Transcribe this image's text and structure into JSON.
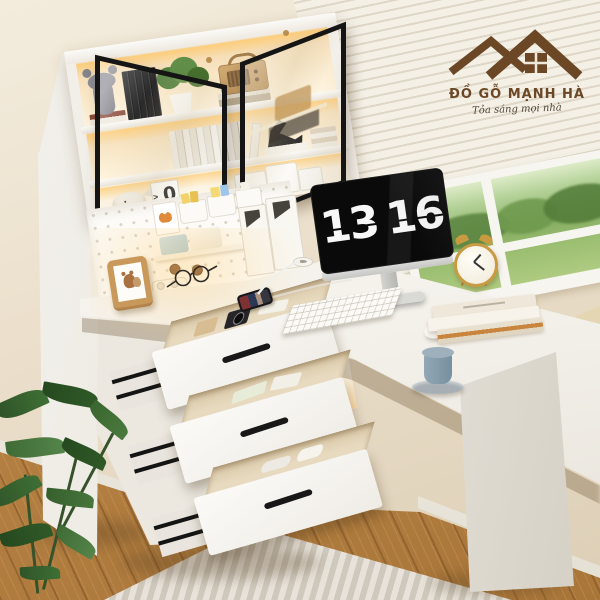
{
  "scene": {
    "description": "White L-shaped corner study desk with LED-lit hutch, glass doors, three open drawers, monitor flip clock, pegboard, window with venetian blinds and garden view",
    "wall_color": "#ebe0cd",
    "floor_color": "#b5813f",
    "desk_color": "#f6f4f0",
    "led_glow_color": "#ffca6e",
    "glass_frame_color": "#151515",
    "drawer_handle_color": "#181818",
    "rug_colors": [
      "#e8e3da",
      "#cfc9bd"
    ],
    "garden_green": "#86ad62",
    "plant_green": "#3e6f35"
  },
  "brand": {
    "name": "ĐỒ GỖ MẠNH HÀ",
    "tagline": "Tỏa sáng mọi nhà",
    "color": "#6b4726",
    "logo_icon": "house-roofs-icon"
  },
  "monitor": {
    "clock_hours": "13",
    "clock_minutes": "16",
    "screen_color": "#0a0a0a",
    "digit_color": "#f7f7f7"
  },
  "desk_calendar": {
    "month": "NOV",
    "day": "0"
  }
}
